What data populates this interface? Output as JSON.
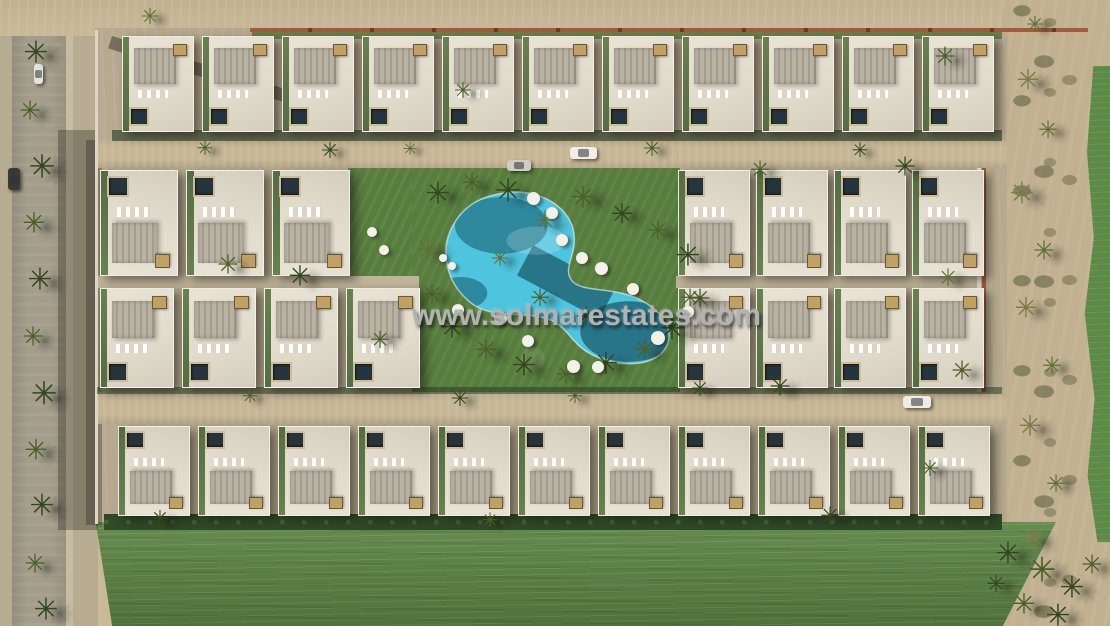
{
  "watermark": {
    "text": "www.solmarestates.com"
  },
  "palette": {
    "sand": "#c8b997",
    "sand_dark": "#b7ab91",
    "road_sand": "#c6b695",
    "asphalt": "#a49d8b",
    "pavement": "#b7aa90",
    "villa_white": "#e2dccd",
    "rib_gray": "#b9b3a4",
    "rib_stripe": "#a49d8e",
    "pool_dark": "#26343d",
    "tan_box": "#bfa164",
    "lawn": "#587e3e",
    "hedge": "#2f4a27",
    "field": "#5c8544",
    "pool_water": "#4ec4de",
    "terracotta": "#a25c3a",
    "golf": "#5e8a48",
    "watermark": "#b2b2b2",
    "shadow": "rgba(28,26,20,0.42)"
  },
  "scene": {
    "palm_glyph": "✳",
    "palm_colors": [
      "#33471f",
      "#4b5f2d",
      "#5f7036",
      "#7b7c4a"
    ],
    "villa_rows": [
      {
        "name": "top-row",
        "x": 122,
        "y": 36,
        "count": 11,
        "w": 72,
        "gap": 8,
        "h": 96,
        "flip": false
      },
      {
        "name": "mid-left-upper",
        "x": 100,
        "y": 170,
        "count": 3,
        "w": 78,
        "gap": 8,
        "h": 106,
        "flip": true
      },
      {
        "name": "mid-left-lower",
        "x": 100,
        "y": 288,
        "count": 4,
        "w": 74,
        "gap": 8,
        "h": 100,
        "flip": false
      },
      {
        "name": "mid-right-upper",
        "x": 678,
        "y": 170,
        "count": 4,
        "w": 72,
        "gap": 6,
        "h": 106,
        "flip": true
      },
      {
        "name": "mid-right-lower",
        "x": 678,
        "y": 288,
        "count": 4,
        "w": 72,
        "gap": 6,
        "h": 100,
        "flip": false
      },
      {
        "name": "bottom-row",
        "x": 118,
        "y": 426,
        "count": 11,
        "w": 72,
        "gap": 8,
        "h": 90,
        "flip": true
      }
    ],
    "palms": [
      [
        36,
        55,
        30,
        0
      ],
      [
        30,
        112,
        26,
        1
      ],
      [
        42,
        168,
        32,
        0
      ],
      [
        34,
        225,
        28,
        1
      ],
      [
        40,
        282,
        30,
        0
      ],
      [
        33,
        338,
        26,
        1
      ],
      [
        44,
        395,
        32,
        0
      ],
      [
        36,
        452,
        28,
        1
      ],
      [
        42,
        508,
        30,
        0
      ],
      [
        35,
        565,
        26,
        1
      ],
      [
        46,
        612,
        30,
        0
      ],
      [
        150,
        18,
        22,
        2
      ],
      [
        463,
        92,
        22,
        1
      ],
      [
        945,
        58,
        26,
        1
      ],
      [
        1035,
        26,
        22,
        2
      ],
      [
        205,
        150,
        20,
        1
      ],
      [
        330,
        152,
        22,
        0
      ],
      [
        410,
        150,
        18,
        2
      ],
      [
        652,
        150,
        22,
        1
      ],
      [
        860,
        152,
        20,
        0
      ],
      [
        438,
        196,
        30,
        0
      ],
      [
        472,
        184,
        26,
        1
      ],
      [
        508,
        192,
        32,
        0
      ],
      [
        545,
        222,
        26,
        2
      ],
      [
        583,
        200,
        30,
        1
      ],
      [
        622,
        216,
        28,
        0
      ],
      [
        658,
        232,
        26,
        1
      ],
      [
        688,
        258,
        30,
        0
      ],
      [
        700,
        300,
        26,
        1
      ],
      [
        672,
        330,
        32,
        0
      ],
      [
        645,
        352,
        28,
        1
      ],
      [
        606,
        366,
        30,
        0
      ],
      [
        566,
        376,
        26,
        1
      ],
      [
        524,
        368,
        30,
        0
      ],
      [
        486,
        352,
        28,
        1
      ],
      [
        452,
        330,
        30,
        0
      ],
      [
        432,
        296,
        26,
        1
      ],
      [
        428,
        252,
        28,
        2
      ],
      [
        540,
        300,
        24,
        1
      ],
      [
        586,
        318,
        26,
        0
      ],
      [
        500,
        260,
        22,
        2
      ],
      [
        228,
        266,
        26,
        1
      ],
      [
        300,
        278,
        28,
        0
      ],
      [
        380,
        342,
        24,
        1
      ],
      [
        760,
        172,
        24,
        1
      ],
      [
        905,
        168,
        26,
        0
      ],
      [
        690,
        300,
        24,
        1
      ],
      [
        780,
        388,
        26,
        0
      ],
      [
        948,
        280,
        24,
        2
      ],
      [
        962,
        372,
        26,
        1
      ],
      [
        700,
        390,
        22,
        0
      ],
      [
        250,
        398,
        20,
        1
      ],
      [
        460,
        400,
        22,
        0
      ],
      [
        575,
        398,
        20,
        1
      ],
      [
        830,
        518,
        24,
        0
      ],
      [
        930,
        470,
        22,
        1
      ],
      [
        160,
        520,
        22,
        0
      ],
      [
        490,
        522,
        20,
        1
      ],
      [
        1028,
        82,
        28,
        3
      ],
      [
        1048,
        132,
        24,
        2
      ],
      [
        1022,
        196,
        30,
        3
      ],
      [
        1044,
        252,
        26,
        2
      ],
      [
        1026,
        310,
        28,
        3
      ],
      [
        1052,
        368,
        24,
        2
      ],
      [
        1030,
        428,
        28,
        3
      ],
      [
        1056,
        486,
        24,
        2
      ],
      [
        1034,
        540,
        26,
        3
      ],
      [
        1008,
        556,
        30,
        0
      ],
      [
        1042,
        572,
        34,
        1
      ],
      [
        1072,
        590,
        30,
        0
      ],
      [
        1024,
        606,
        28,
        1
      ],
      [
        1058,
        618,
        30,
        0
      ],
      [
        1092,
        566,
        26,
        1
      ],
      [
        996,
        586,
        24,
        0
      ]
    ],
    "umbrellas": [
      [
        533,
        198,
        13
      ],
      [
        552,
        213,
        12
      ],
      [
        562,
        240,
        12
      ],
      [
        582,
        258,
        12
      ],
      [
        601,
        268,
        13
      ],
      [
        458,
        310,
        12
      ],
      [
        500,
        318,
        13
      ],
      [
        528,
        341,
        12
      ],
      [
        573,
        366,
        13
      ],
      [
        598,
        367,
        12
      ],
      [
        658,
        338,
        14
      ],
      [
        633,
        289,
        12
      ],
      [
        688,
        312,
        12
      ],
      [
        443,
        258,
        8
      ],
      [
        452,
        266,
        8
      ],
      [
        372,
        232,
        10
      ],
      [
        384,
        250,
        10
      ]
    ],
    "cars": [
      {
        "x": 570,
        "y": 147,
        "w": 27,
        "h": 12,
        "color": "#f0eee6",
        "dir": "h"
      },
      {
        "x": 507,
        "y": 160,
        "w": 24,
        "h": 11,
        "color": "#cfccc2",
        "dir": "h"
      },
      {
        "x": 903,
        "y": 396,
        "w": 28,
        "h": 12,
        "color": "#efede5",
        "dir": "h"
      },
      {
        "x": 8,
        "y": 168,
        "w": 12,
        "h": 22,
        "color": "#3a3a35",
        "dir": "v"
      },
      {
        "x": 34,
        "y": 64,
        "w": 9,
        "h": 20,
        "color": "#e6e4da",
        "dir": "v"
      }
    ]
  }
}
